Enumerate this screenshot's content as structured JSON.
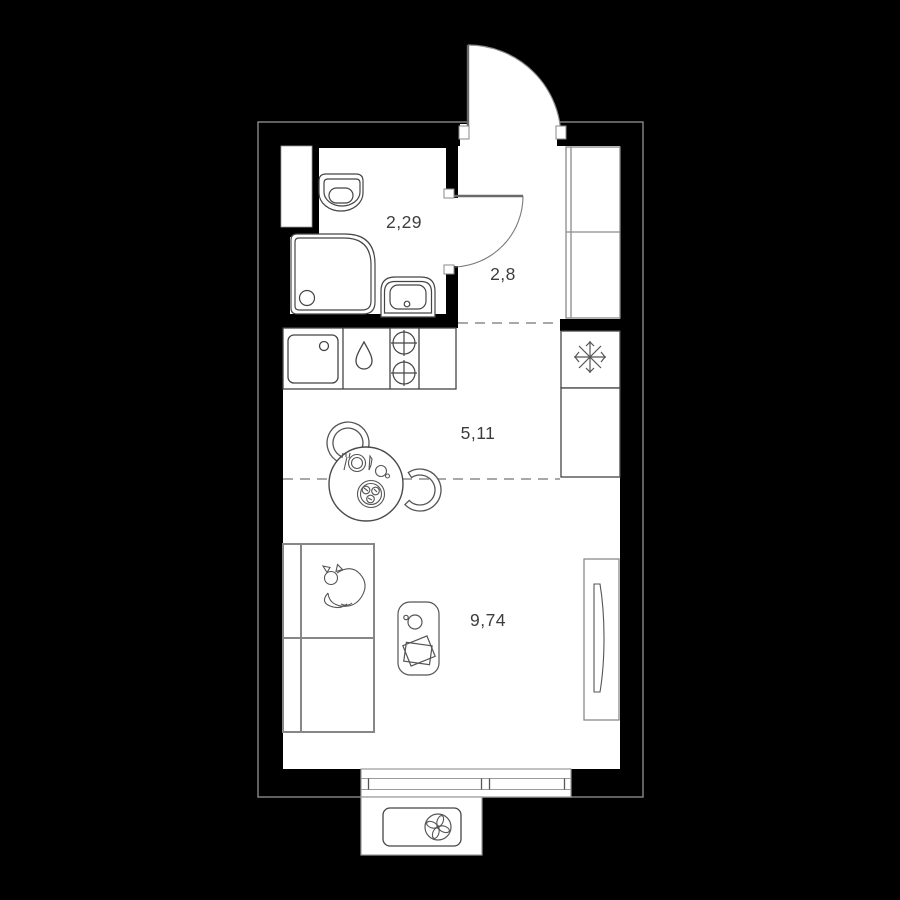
{
  "plan": {
    "type": "apartment-floor-plan",
    "style": "studio",
    "decimal_separator": ",",
    "rooms": {
      "bathroom": {
        "name": "bathroom",
        "area": "2,29"
      },
      "hallway": {
        "name": "hallway",
        "area": "2,8"
      },
      "kitchen": {
        "name": "kitchen",
        "area": "5,11"
      },
      "living_room": {
        "name": "living room",
        "area": "9,74"
      }
    },
    "fixtures": {
      "bathroom": [
        "ventilation-shaft",
        "toilet",
        "shower",
        "washbasin",
        "interior-door"
      ],
      "hallway": [
        "entrance-door",
        "wardrobe"
      ],
      "kitchen": [
        "kitchen-sink",
        "water-drop-icon",
        "stove-two-burners",
        "counter",
        "fridge",
        "snowflake-icon"
      ],
      "living_room": [
        "dining-table",
        "chair",
        "chair",
        "sofa-bed",
        "cat-icon",
        "side-table",
        "cup",
        "book",
        "tv-stand",
        "tv"
      ],
      "balcony": [
        "window",
        "ac-unit",
        "fan-icon"
      ]
    },
    "colors": {
      "background": "#000000",
      "wall": "#000000",
      "floor": "#ffffff",
      "fixture_line": "#454545",
      "furniture_line": "#878787",
      "outline": "#9a9a9a",
      "dashed_zone_line": "#a8a8a8",
      "label_text": "#3d3d3d"
    }
  }
}
